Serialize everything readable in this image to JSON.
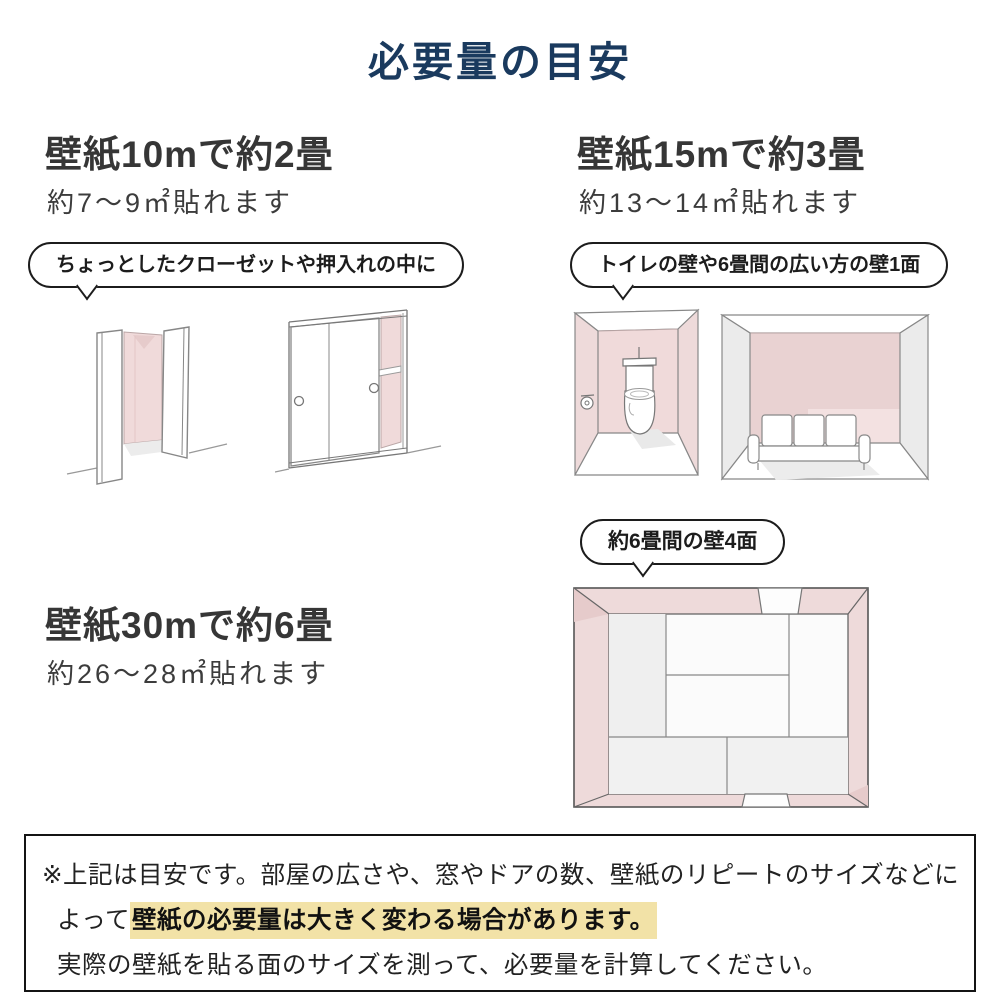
{
  "title": "必要量の目安",
  "colors": {
    "accent_navy": "#1a3a5e",
    "wall_pink": "#f0dada",
    "highlight_yellow": "#f2e2a7"
  },
  "sections": {
    "s10m": {
      "heading": "壁紙10mで約2畳",
      "subtext": "約7〜9㎡貼れます",
      "bubble": "ちょっとしたクローゼットや押入れの中に",
      "illustrations": [
        "closet-open-doors",
        "oshiire-sliding-doors"
      ]
    },
    "s15m": {
      "heading": "壁紙15mで約3畳",
      "subtext": "約13〜14㎡貼れます",
      "bubble": "トイレの壁や6畳間の広い方の壁1面",
      "illustrations": [
        "toilet-room",
        "sofa-room"
      ]
    },
    "s30m": {
      "heading": "壁紙30mで約6畳",
      "subtext": "約26〜28㎡貼れます",
      "bubble": "約6畳間の壁4面",
      "illustrations": [
        "tatami-room-top-view"
      ]
    }
  },
  "note": {
    "line1": "※上記は目安です。部屋の広さや、窓やドアの数、壁紙のリピートのサイズなどに",
    "line2_prefix": "よって",
    "line2_highlight": "壁紙の必要量は大きく変わる場合があります。",
    "line3": "実際の壁紙を貼る面のサイズを測って、必要量を計算してください。"
  }
}
